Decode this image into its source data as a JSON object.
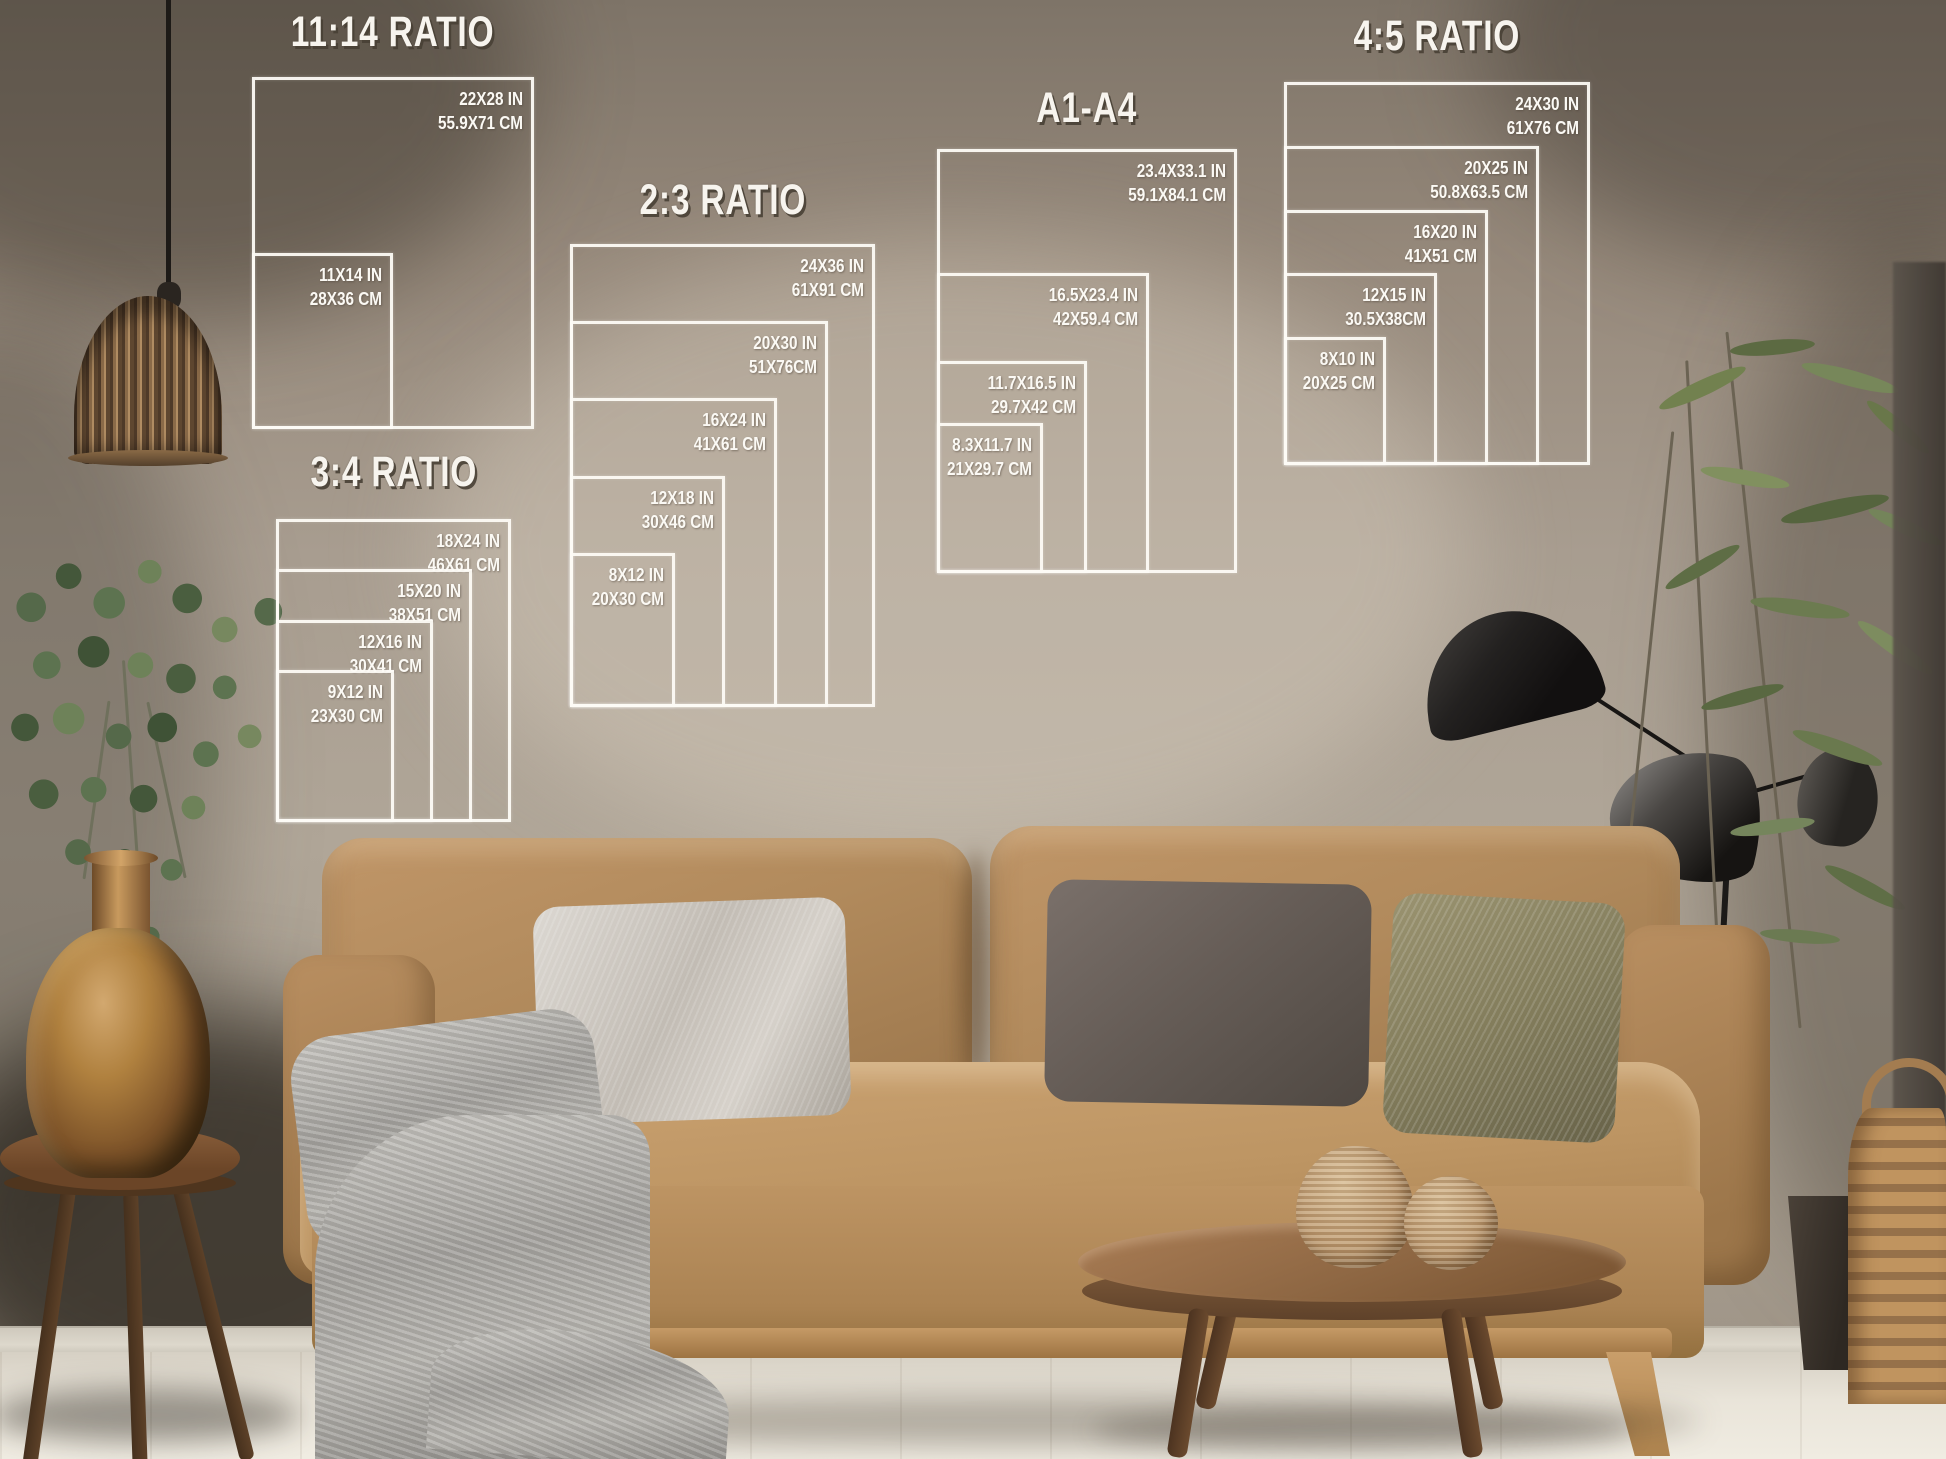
{
  "palette": {
    "overlay_white": "#FBF9F4",
    "wall": "#A89D90",
    "sofa_tan": "#B18A5C",
    "floor": "#E9E4D9"
  },
  "charts": [
    {
      "title": "11:14 RATIO",
      "sizes": [
        {
          "in": "22X28 IN",
          "cm": "55.9X71 CM"
        },
        {
          "in": "11X14 IN",
          "cm": "28X36 CM"
        }
      ]
    },
    {
      "title": "3:4 RATIO",
      "sizes": [
        {
          "in": "18X24 IN",
          "cm": "46X61 CM"
        },
        {
          "in": "15X20 IN",
          "cm": "38X51 CM"
        },
        {
          "in": "12X16 IN",
          "cm": "30X41 CM"
        },
        {
          "in": "9X12 IN",
          "cm": "23X30 CM"
        }
      ]
    },
    {
      "title": "2:3 RATIO",
      "sizes": [
        {
          "in": "24X36 IN",
          "cm": "61X91 CM"
        },
        {
          "in": "20X30 IN",
          "cm": "51X76CM"
        },
        {
          "in": "16X24 IN",
          "cm": "41X61 CM"
        },
        {
          "in": "12X18 IN",
          "cm": "30X46 CM"
        },
        {
          "in": "8X12 IN",
          "cm": "20X30 CM"
        }
      ]
    },
    {
      "title": "A1-A4",
      "sizes": [
        {
          "in": "23.4X33.1 IN",
          "cm": "59.1X84.1 CM"
        },
        {
          "in": "16.5X23.4 IN",
          "cm": "42X59.4 CM"
        },
        {
          "in": "11.7X16.5 IN",
          "cm": "29.7X42 CM"
        },
        {
          "in": "8.3X11.7 IN",
          "cm": "21X29.7 CM"
        }
      ]
    },
    {
      "title": "4:5 RATIO",
      "sizes": [
        {
          "in": "24X30 IN",
          "cm": "61X76 CM"
        },
        {
          "in": "20X25 IN",
          "cm": "50.8X63.5 CM"
        },
        {
          "in": "16X20 IN",
          "cm": "41X51 CM"
        },
        {
          "in": "12X15 IN",
          "cm": "30.5X38CM"
        },
        {
          "in": "8X10 IN",
          "cm": "20X25 CM"
        }
      ]
    }
  ]
}
